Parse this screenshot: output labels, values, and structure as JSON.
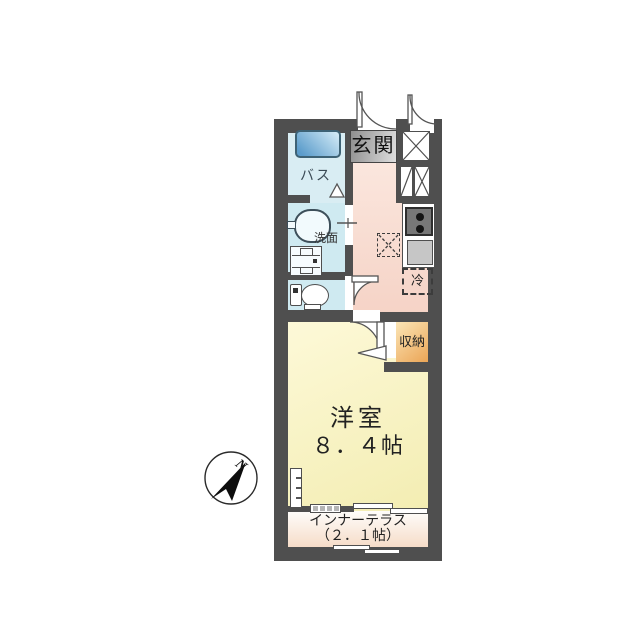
{
  "labels": {
    "entrance": "玄関",
    "bath": "バス",
    "washbasin": "洗面",
    "refrigerator": "冷",
    "storage": "収納",
    "room_name": "洋室",
    "room_size": "８．４帖",
    "terrace_name": "インナーテラス",
    "terrace_size": "（２．１帖）",
    "compass_north": "N"
  },
  "colors": {
    "wall": "#4f4f4f",
    "bath_floor": "#d9edf3",
    "sanitary_floor": "#cfeaf1",
    "bathtub_dark": "#5b9ccb",
    "bathtub_light": "#d6edf8",
    "hall_top": "#fceae2",
    "hall_bottom": "#f5d2c5",
    "room_top": "#fdf9d8",
    "room_bottom": "#f3edb2",
    "terrace_top": "#fefdfb",
    "terrace_bottom": "#f6dcc8",
    "storage_top": "#fbe5b6",
    "storage_bottom": "#eba556",
    "entrance_box": "#9a9a9a",
    "line": "#555555"
  }
}
